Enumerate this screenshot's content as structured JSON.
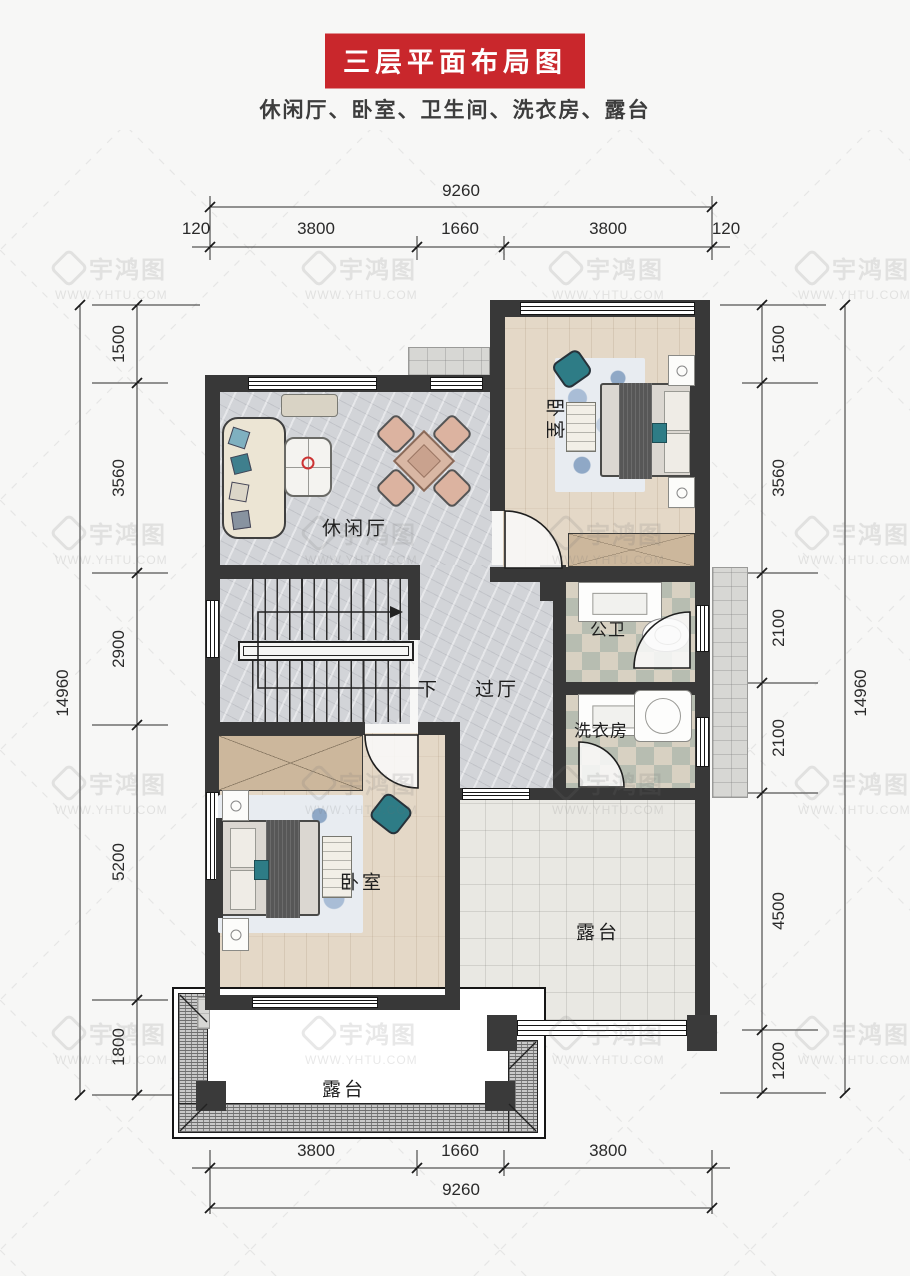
{
  "title": "三层平面布局图",
  "subtitle": "休闲厅、卧室、卫生间、洗衣房、露台",
  "watermark": {
    "brand": "宇鸿图",
    "url": "WWW.YHTU.COM"
  },
  "rooms": {
    "leisure": "休闲厅",
    "bedroom_top": "卧室",
    "bedroom_bottom": "卧室",
    "bath": "公卫",
    "laundry": "洗衣房",
    "hall": "过厅",
    "stairs_down": "下",
    "terrace_right": "露台",
    "terrace_bottom": "露台"
  },
  "dimensions": {
    "top": {
      "total": "9260",
      "segments": [
        "120",
        "3800",
        "1660",
        "3800",
        "120"
      ]
    },
    "bottom": {
      "total": "9260",
      "segments": [
        "3800",
        "1660",
        "3800"
      ]
    },
    "left": {
      "total": "14960",
      "segments": [
        "1500",
        "3560",
        "2900",
        "5200",
        "1800"
      ]
    },
    "right": {
      "total": "14960",
      "segments": [
        "1500",
        "3560",
        "2100",
        "2100",
        "4500",
        "1200"
      ]
    }
  },
  "colors": {
    "accent_red": "#c9272c",
    "wall": "#383838",
    "marble_floor": "#d2d4d8",
    "wood_floor": "#e4d8c7",
    "bath_tile_a": "#b7bdb1",
    "bath_tile_b": "#d8d1c2",
    "terrace_tile": "#e9e8e3",
    "teal_accent": "#2e7c86"
  }
}
